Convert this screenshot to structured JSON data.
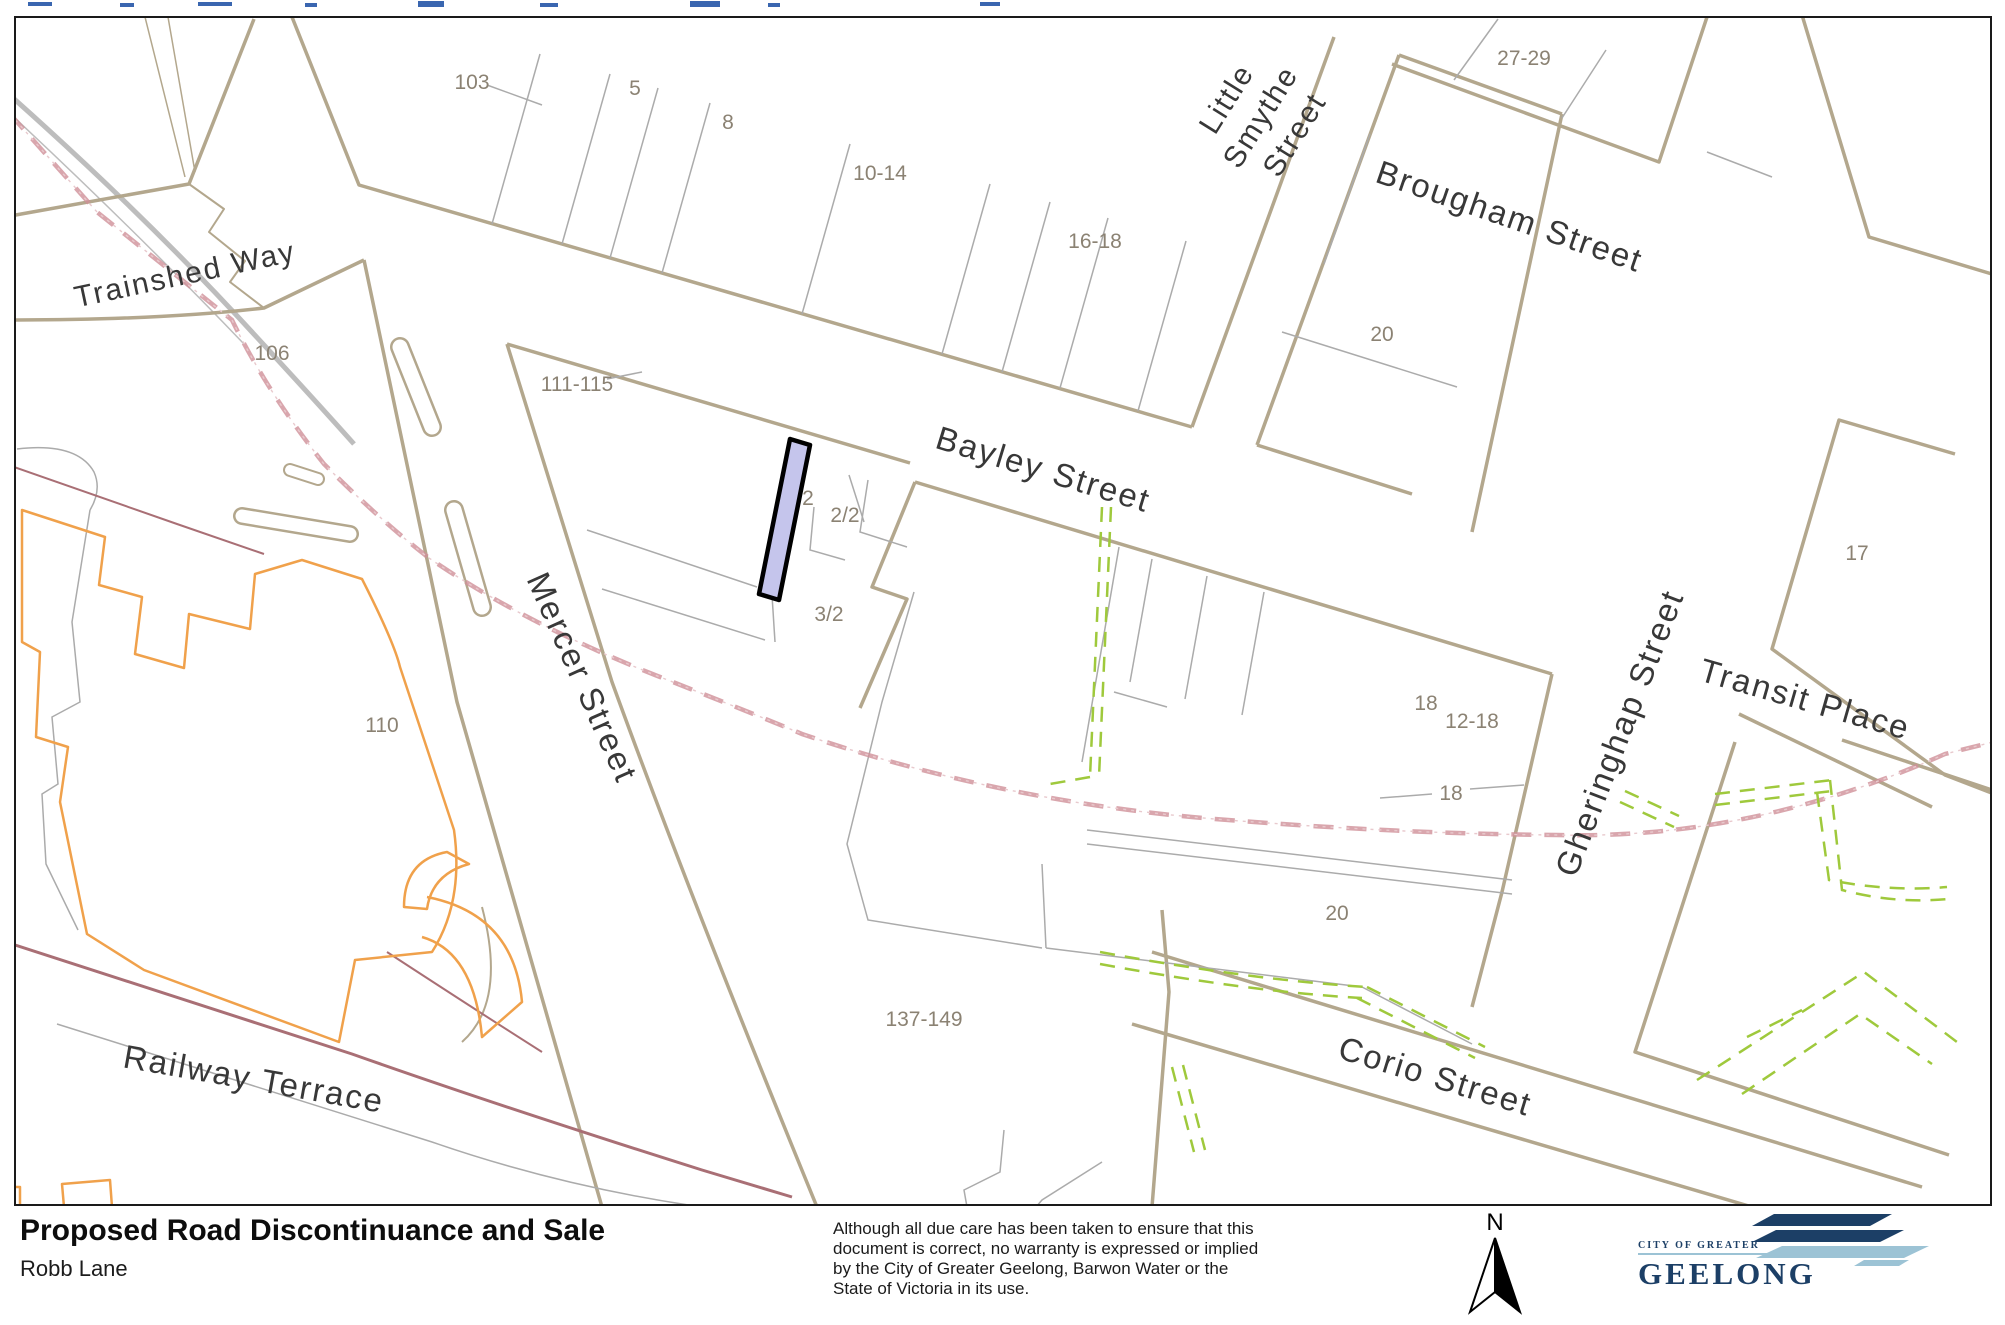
{
  "page": {
    "title": "Proposed Road Discontinuance and Sale",
    "subtitle": "Robb Lane",
    "disclaimer_lines": [
      "Although all due care has been taken to ensure that this",
      "document is correct, no warranty is expressed or implied",
      "by the City of Greater Geelong, Barwon Water or the",
      "State of Victoria in its use."
    ],
    "north_label": "N"
  },
  "logo": {
    "small": "CITY OF GREATER",
    "large": "GEELONG"
  },
  "map": {
    "streets": [
      {
        "label": "Trainshed Way"
      },
      {
        "label": "Brougham Street"
      },
      {
        "label": "Bayley Street"
      },
      {
        "label": "Mercer Street"
      },
      {
        "label": "Gheringhap Street"
      },
      {
        "label": "Transit Place"
      },
      {
        "label": "Corio Street"
      },
      {
        "label": "Railway Terrace"
      }
    ],
    "little_smythe_lines": [
      "Little",
      "Smythe",
      "Street"
    ],
    "parcels": [
      {
        "label": "103"
      },
      {
        "label": "5"
      },
      {
        "label": "8"
      },
      {
        "label": "10-14"
      },
      {
        "label": "16-18"
      },
      {
        "label": "20"
      },
      {
        "label": "27-29"
      },
      {
        "label": "106"
      },
      {
        "label": "111-115"
      },
      {
        "label": "2"
      },
      {
        "label": "2/2"
      },
      {
        "label": "3/2"
      },
      {
        "label": "110"
      },
      {
        "label": "137-149"
      },
      {
        "label": "18"
      },
      {
        "label": "12-18"
      },
      {
        "label": "18"
      },
      {
        "label": "20"
      },
      {
        "label": "17"
      }
    ],
    "colors": {
      "highlight_fill": "#c5c5ec",
      "highlight_outline": "#000000",
      "block_outline": "#b3a78d",
      "internal_line": "#ababab",
      "railway_pink": "#cf9099",
      "services_green": "#9fc93c",
      "building_orange": "#f0a14b",
      "road_maroon": "#a96f75",
      "track_gray": "#bdbdbd"
    }
  }
}
